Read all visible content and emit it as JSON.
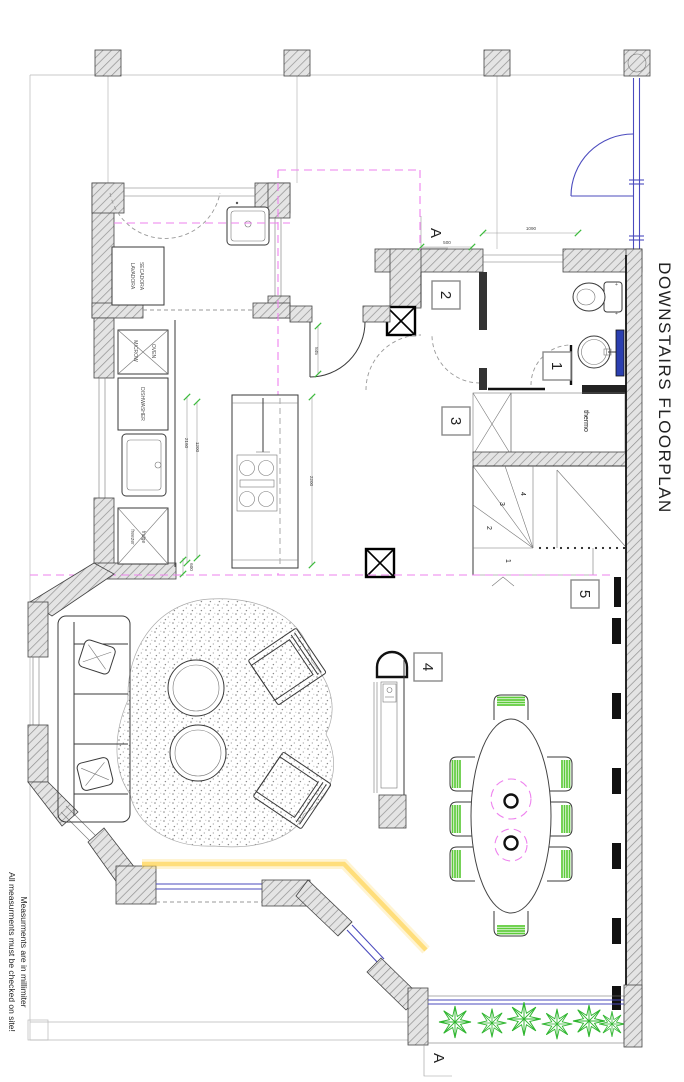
{
  "title": "DOWNSTAIRS FLOORPLAN",
  "notes": {
    "line1": "Measurments are in millimiter",
    "line2": "All measurments must be checked on site!"
  },
  "section_markers": {
    "top": "A",
    "bottom": "A"
  },
  "room_labels": {
    "wc": "1",
    "entry": "2",
    "closet": "3",
    "fireplace": "4",
    "stairs": "5"
  },
  "appliances": {
    "washer": "LAVADORA",
    "dryer": "SECADORA",
    "microwave": "MICROW",
    "oven": "OVEN",
    "dishwasher": "DISHWASHER",
    "freezer": "freezer",
    "fridge": "fridge",
    "water_heater": "thermo"
  },
  "stair_treads": [
    "1",
    "2",
    "3",
    "4"
  ],
  "dimensions": {
    "entry_offset": "500",
    "entry_window": "1090",
    "kitchen_door": "845",
    "island_length": "2160",
    "island_worktop": "1200",
    "island_side": "2200",
    "island_width": "600"
  },
  "colors": {
    "magenta": "#ee82ee",
    "dim_green": "#3dbb3d",
    "window_blue": "#4b4bbe",
    "vanity_blue": "#2b3fb0",
    "chair_green": "#5ecb3a",
    "tree_green": "#2db52d",
    "accent_yellow": "#ffd34d",
    "wall_fill": "#e4e4e4",
    "hatch_line": "#909090"
  }
}
